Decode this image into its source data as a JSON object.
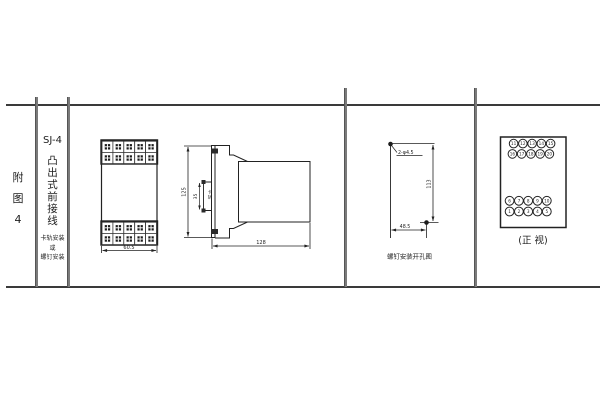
{
  "page": {
    "line_color": "#3a3a3a",
    "drawing_color": "#222222"
  },
  "left_label": {
    "chars": [
      "附",
      "图",
      "4"
    ]
  },
  "title_column": {
    "model": "SJ-4",
    "vertical_chars": [
      "凸",
      "出",
      "式",
      "前",
      "接",
      "线"
    ],
    "sub_lines": [
      "卡轨安装",
      "或",
      "螺钉安装"
    ]
  },
  "front_view": {
    "width_dim": "60.5",
    "screw_rows": 2,
    "screw_cols": 5
  },
  "side_view": {
    "height_dim": "125",
    "rail_dim": "35",
    "rail_label_chars": [
      "卡",
      "轨"
    ],
    "depth_dim": "128"
  },
  "hole_view": {
    "holes_label": "2-φ4.5",
    "vertical_dim": "113",
    "horizontal_dim": "48.5",
    "caption": "螺钉安装开孔图"
  },
  "terminal_view": {
    "caption": "(正 视)",
    "top_rows": [
      [
        "11",
        "12",
        "13",
        "14",
        "15"
      ],
      [
        "16",
        "17",
        "18",
        "19",
        "20"
      ]
    ],
    "bottom_rows": [
      [
        "6",
        "7",
        "8",
        "9",
        "10"
      ],
      [
        "1",
        "2",
        "3",
        "4",
        "5"
      ]
    ]
  }
}
